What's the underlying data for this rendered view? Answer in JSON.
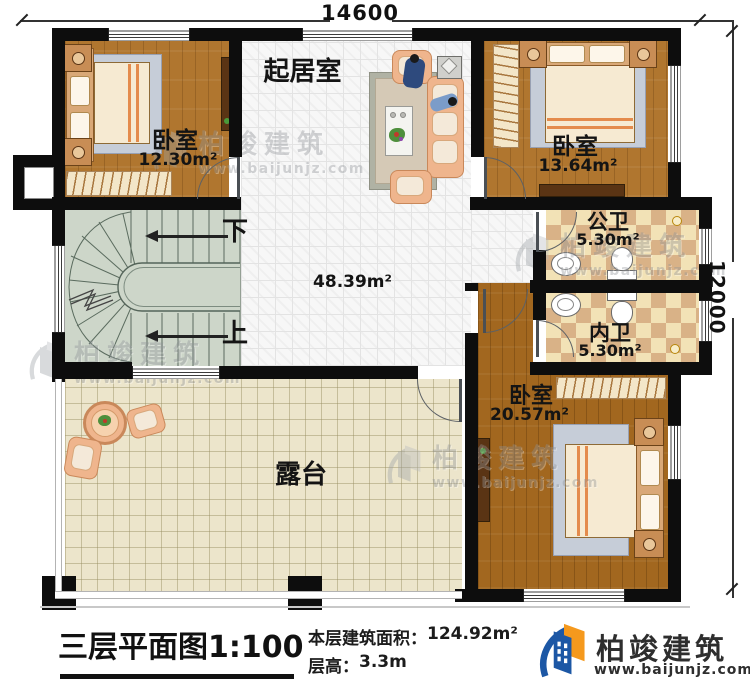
{
  "dimensions": {
    "width": "14600",
    "height": "12000"
  },
  "rooms": {
    "living": {
      "label": "起居室"
    },
    "bedroom1": {
      "label": "卧室",
      "area": "12.30m²"
    },
    "bedroom2": {
      "label": "卧室",
      "area": "13.64m²"
    },
    "bedroom3": {
      "label": "卧室",
      "area": "20.57m²"
    },
    "public_bath": {
      "label": "公卫",
      "area": "5.30m²"
    },
    "inner_bath": {
      "label": "内卫",
      "area": "5.30m²"
    },
    "hall": {
      "area": "48.39m²"
    },
    "terrace": {
      "label": "露台"
    }
  },
  "stairs": {
    "down_label": "下",
    "up_label": "上"
  },
  "footer": {
    "plan_title": "三层平面图",
    "plan_scale": "1:100",
    "floor_area_label": "本层建筑面积：",
    "floor_area_value": "124.92m²",
    "floor_height_label": "层高：",
    "floor_height_value": "3.3m"
  },
  "brand": {
    "name": "柏竣建筑",
    "website": "www.baijunjz.com"
  },
  "watermark": {
    "name": "柏竣建筑",
    "website": "www.baijunjz.com"
  },
  "icons": {
    "brand_logo": "building-logo-icon",
    "watermark_logo": "building-watermark-icon"
  },
  "colors": {
    "wall": "#0d0d0d",
    "wood_floor": "#b0762f",
    "wood_floor_dark": "#a2671f",
    "bath_tile_light": "#f2e2b6",
    "bath_tile_dark": "#d9b287",
    "stairs_floor": "#cdd6c9",
    "terrace_floor": "#ece5cb",
    "brand_blue": "#1c57a5",
    "brand_orange": "#f5991d"
  }
}
